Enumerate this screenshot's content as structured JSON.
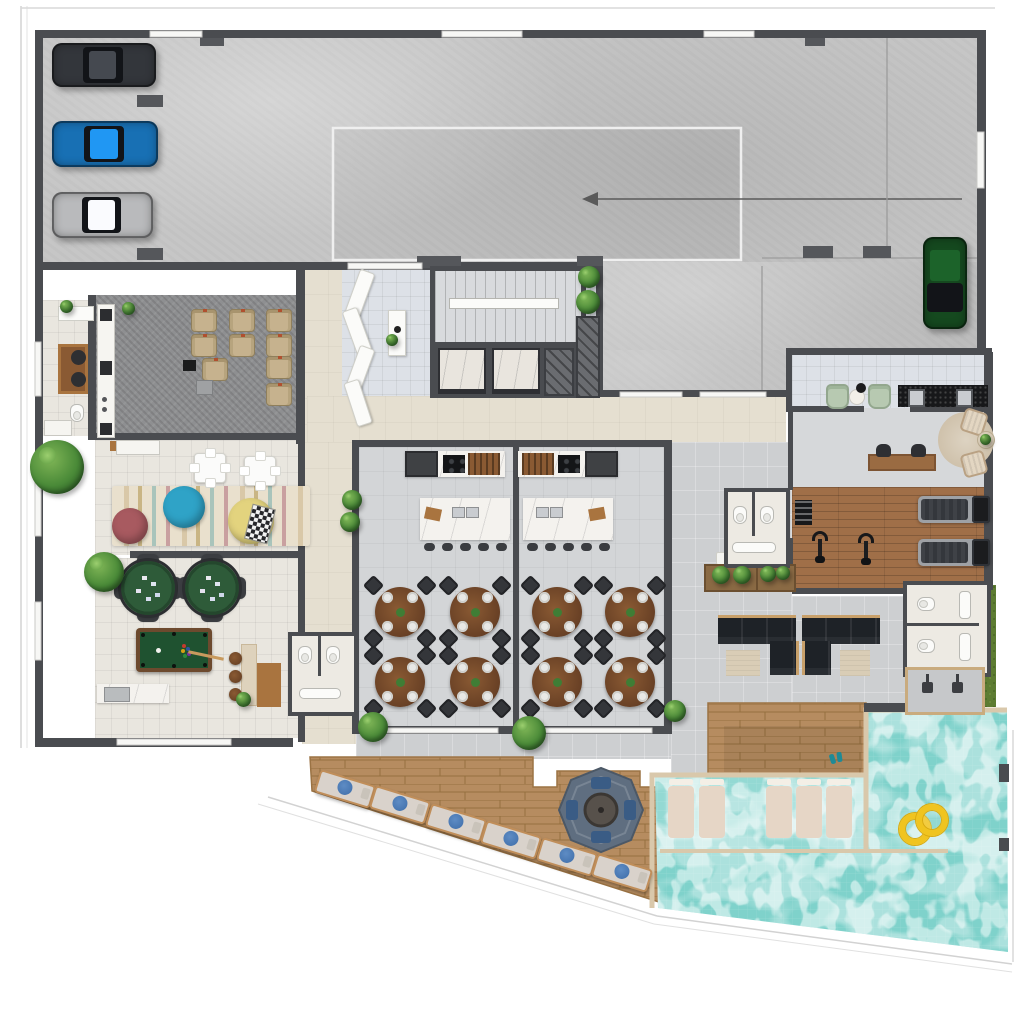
{
  "scene": {
    "width": 1024,
    "height": 1034,
    "kind": "architectural floor plan, top-down 3D render, ground floor amenities + parking"
  },
  "palette": {
    "wall": "#4a4c50",
    "pillar": "#55575b",
    "concrete": "#c6c6c6",
    "tile_light": "#e9e6df",
    "tile_lobby": "#dde1e7",
    "corridor": "#e5dfd0",
    "party_floor": "#d3d5d7",
    "patio": "#cdcfd1",
    "carpet_cinema": "#8e8f91",
    "cinema_seat": "#c6b28e",
    "wood_gym": "#a06f48",
    "wood_deck": "#b68c60",
    "marble": "#f4f2ee",
    "granite": "#17181a",
    "pool_water": "#7fd2cb",
    "pool_curb": "#d9c8ab",
    "grass": "#5d7c32",
    "plant": "#3f7d35",
    "sofa": "#1e2227",
    "rug_beige": "#d9cdb6",
    "felt_green": "#2e5b39",
    "billiard_green": "#1f5230",
    "billiard_wood": "#6d4a2e",
    "towel_blue": "#3e6da9",
    "accent_swimring": "#f0c41f",
    "gazebo": "#5f6e80",
    "cushion_blue": "#3a5c85",
    "armchair_green": "#b7c9b1",
    "car_dark": "#33363b",
    "car_blue": "#1870b4",
    "car_silver": "#b9babc",
    "car_green": "#15491f",
    "bean_rose": "#a85a60",
    "bean_blue": "#2fa3c7",
    "bean_yellow": "#e3d37e"
  },
  "areas": [
    "parking-garage",
    "ramp",
    "lobby",
    "staircase",
    "elevators",
    "cinema-room",
    "office",
    "kids-playroom",
    "games-room",
    "party-room-a",
    "party-room-b",
    "gourmet-kitchens",
    "restrooms",
    "corridor",
    "outdoor-lounge",
    "coffee-corner",
    "gym",
    "changing-rooms",
    "outdoor-showers",
    "wood-deck",
    "gazebo-firepit",
    "swimming-pool",
    "wet-deck",
    "sun-deck"
  ],
  "inventory": {
    "parking_cars": 4,
    "cinema_recliners": 9,
    "dining_tables": 8,
    "seats_per_table": 4,
    "kitchen_islands": 2,
    "island_stools": 10,
    "poker_tables": 2,
    "billiard_tables": 1,
    "bar_stools": 3,
    "bean_bags": 3,
    "kids_tables": 2,
    "l_shaped_sofas": 2,
    "exercise_bikes": 2,
    "treadmills": 2,
    "deck_loungers": 6,
    "wet_deck_loungers": 5,
    "swim_rings": 2,
    "gazebos": 1,
    "outdoor_showers": 2,
    "wc_stalls": 6,
    "elevators": 2,
    "stair_flights": 1
  },
  "furniture": {
    "cars": [
      {
        "n": "car-suv-dark",
        "cls": "car",
        "s": {
          "left": "52px",
          "top": "43px",
          "width": "104px",
          "height": "44px",
          "--cc": "#33363b"
        }
      },
      {
        "n": "car-blue",
        "cls": "car",
        "s": {
          "left": "52px",
          "top": "121px",
          "width": "106px",
          "height": "46px",
          "--cc": "#1870b4"
        }
      },
      {
        "n": "car-silver",
        "cls": "car",
        "s": {
          "left": "52px",
          "top": "192px",
          "width": "101px",
          "height": "46px",
          "--cc": "#b9babc"
        }
      },
      {
        "n": "car-green",
        "cls": "car v",
        "s": {
          "left": "923px",
          "top": "237px",
          "width": "44px",
          "height": "92px",
          "--cc": "#15491f"
        }
      }
    ],
    "cinema_seats": [
      {
        "s": {
          "left": "191px",
          "top": "309px"
        }
      },
      {
        "s": {
          "left": "229px",
          "top": "309px"
        }
      },
      {
        "s": {
          "left": "266px",
          "top": "309px"
        }
      },
      {
        "s": {
          "left": "191px",
          "top": "334px"
        }
      },
      {
        "s": {
          "left": "229px",
          "top": "334px"
        }
      },
      {
        "s": {
          "left": "266px",
          "top": "334px"
        }
      },
      {
        "s": {
          "left": "202px",
          "top": "358px"
        }
      },
      {
        "s": {
          "left": "266px",
          "top": "356px"
        }
      },
      {
        "s": {
          "left": "266px",
          "top": "383px"
        }
      }
    ],
    "dining_sets": [
      {
        "s": {
          "left": "368px",
          "top": "580px"
        }
      },
      {
        "s": {
          "left": "443px",
          "top": "580px"
        }
      },
      {
        "s": {
          "left": "368px",
          "top": "650px"
        }
      },
      {
        "s": {
          "left": "443px",
          "top": "650px"
        }
      },
      {
        "s": {
          "left": "525px",
          "top": "580px"
        }
      },
      {
        "s": {
          "left": "598px",
          "top": "580px"
        }
      },
      {
        "s": {
          "left": "525px",
          "top": "650px"
        }
      },
      {
        "s": {
          "left": "598px",
          "top": "650px"
        }
      }
    ],
    "island_stools": [
      {
        "s": {
          "left": "424px",
          "top": "543px"
        }
      },
      {
        "s": {
          "left": "442px",
          "top": "543px"
        }
      },
      {
        "s": {
          "left": "460px",
          "top": "543px"
        }
      },
      {
        "s": {
          "left": "478px",
          "top": "543px"
        }
      },
      {
        "s": {
          "left": "496px",
          "top": "543px"
        }
      },
      {
        "s": {
          "left": "527px",
          "top": "543px"
        }
      },
      {
        "s": {
          "left": "545px",
          "top": "543px"
        }
      },
      {
        "s": {
          "left": "563px",
          "top": "543px"
        }
      },
      {
        "s": {
          "left": "581px",
          "top": "543px"
        }
      },
      {
        "s": {
          "left": "599px",
          "top": "543px"
        }
      }
    ],
    "poker_sets": [
      {
        "s": {
          "left": "116px",
          "top": "556px"
        }
      },
      {
        "s": {
          "left": "180px",
          "top": "556px"
        }
      }
    ],
    "bar_stools": [
      {
        "s": {
          "left": "229px",
          "top": "652px"
        }
      },
      {
        "s": {
          "left": "229px",
          "top": "670px"
        }
      },
      {
        "s": {
          "left": "229px",
          "top": "688px"
        }
      }
    ],
    "kids_tables": [
      {
        "s": {
          "left": "194px",
          "top": "453px"
        }
      },
      {
        "s": {
          "left": "244px",
          "top": "456px"
        }
      }
    ],
    "bean_bags": [
      {
        "n": "bean-bag-rose",
        "s": {
          "left": "112px",
          "top": "508px",
          "width": "36px",
          "height": "36px",
          "background": "#a85a60"
        }
      },
      {
        "n": "bean-bag-blue",
        "s": {
          "left": "163px",
          "top": "486px",
          "width": "42px",
          "height": "42px",
          "background": "#2fa3c7"
        }
      },
      {
        "n": "bean-bag-yellow",
        "s": {
          "left": "228px",
          "top": "498px",
          "width": "46px",
          "height": "46px",
          "background": "#e3d37e"
        }
      }
    ],
    "deck_loungers": [
      {
        "s": {
          "left": "316px",
          "top": "777px",
          "transform": "rotate(17deg)"
        }
      },
      {
        "s": {
          "left": "371px",
          "top": "793px",
          "transform": "rotate(17deg)"
        }
      },
      {
        "s": {
          "left": "427px",
          "top": "811px",
          "transform": "rotate(17deg)"
        }
      },
      {
        "s": {
          "left": "482px",
          "top": "828px",
          "transform": "rotate(17deg)"
        }
      },
      {
        "s": {
          "left": "538px",
          "top": "845px",
          "transform": "rotate(17deg)"
        }
      },
      {
        "s": {
          "left": "593px",
          "top": "861px",
          "transform": "rotate(17deg)"
        }
      }
    ],
    "wet_loungers": [
      {
        "s": {
          "left": "668px",
          "top": "786px"
        }
      },
      {
        "s": {
          "left": "699px",
          "top": "786px"
        }
      },
      {
        "s": {
          "left": "766px",
          "top": "786px"
        }
      },
      {
        "s": {
          "left": "796px",
          "top": "786px"
        }
      },
      {
        "s": {
          "left": "826px",
          "top": "786px"
        }
      }
    ],
    "bikes": [
      {
        "s": {
          "left": "812px",
          "top": "531px"
        }
      },
      {
        "s": {
          "left": "858px",
          "top": "533px"
        }
      }
    ],
    "treadmills": [
      {
        "s": {
          "left": "918px",
          "top": "496px"
        }
      },
      {
        "s": {
          "left": "918px",
          "top": "539px"
        }
      }
    ],
    "swim_rings": [
      {
        "s": {
          "left": "899px",
          "top": "813px"
        }
      },
      {
        "s": {
          "left": "916px",
          "top": "804px"
        }
      }
    ],
    "lobby_benches": [
      {
        "s": {
          "left": "352px",
          "top": "270px",
          "transform": "rotate(20deg)"
        }
      },
      {
        "s": {
          "left": "349px",
          "top": "308px",
          "transform": "rotate(-20deg)"
        }
      },
      {
        "s": {
          "left": "352px",
          "top": "346px",
          "transform": "rotate(20deg)"
        }
      },
      {
        "s": {
          "left": "350px",
          "top": "380px",
          "transform": "rotate(-18deg)"
        }
      }
    ],
    "green_chairs": [
      {
        "s": {
          "left": "826px",
          "top": "384px"
        }
      },
      {
        "s": {
          "left": "868px",
          "top": "384px"
        }
      }
    ],
    "desk_chairs": [
      {
        "s": {
          "left": "876px",
          "top": "444px"
        }
      },
      {
        "s": {
          "left": "911px",
          "top": "444px"
        }
      }
    ],
    "plants": [
      {
        "n": "plant-large",
        "s": {
          "left": "30px",
          "top": "440px",
          "width": "54px",
          "height": "54px"
        }
      },
      {
        "s": {
          "left": "84px",
          "top": "552px",
          "width": "40px",
          "height": "40px"
        }
      },
      {
        "s": {
          "left": "342px",
          "top": "490px",
          "width": "20px",
          "height": "20px"
        }
      },
      {
        "s": {
          "left": "340px",
          "top": "512px",
          "width": "20px",
          "height": "20px"
        }
      },
      {
        "s": {
          "left": "358px",
          "top": "712px",
          "width": "30px",
          "height": "30px"
        }
      },
      {
        "s": {
          "left": "512px",
          "top": "716px",
          "width": "34px",
          "height": "34px"
        }
      },
      {
        "s": {
          "left": "578px",
          "top": "266px",
          "width": "22px",
          "height": "22px"
        }
      },
      {
        "s": {
          "left": "576px",
          "top": "290px",
          "width": "24px",
          "height": "24px"
        }
      },
      {
        "s": {
          "left": "664px",
          "top": "700px",
          "width": "22px",
          "height": "22px"
        }
      },
      {
        "s": {
          "left": "236px",
          "top": "692px",
          "width": "15px",
          "height": "15px"
        }
      },
      {
        "s": {
          "left": "60px",
          "top": "300px",
          "width": "13px",
          "height": "13px"
        }
      },
      {
        "s": {
          "left": "122px",
          "top": "302px",
          "width": "13px",
          "height": "13px"
        }
      },
      {
        "s": {
          "left": "386px",
          "top": "334px",
          "width": "12px",
          "height": "12px"
        }
      },
      {
        "s": {
          "left": "980px",
          "top": "434px",
          "width": "11px",
          "height": "11px"
        }
      },
      {
        "s": {
          "left": "712px",
          "top": "566px",
          "width": "18px",
          "height": "18px"
        }
      },
      {
        "s": {
          "left": "733px",
          "top": "566px",
          "width": "18px",
          "height": "18px"
        }
      },
      {
        "s": {
          "left": "760px",
          "top": "566px",
          "width": "16px",
          "height": "16px"
        }
      },
      {
        "s": {
          "left": "776px",
          "top": "566px",
          "width": "14px",
          "height": "14px"
        }
      }
    ]
  }
}
